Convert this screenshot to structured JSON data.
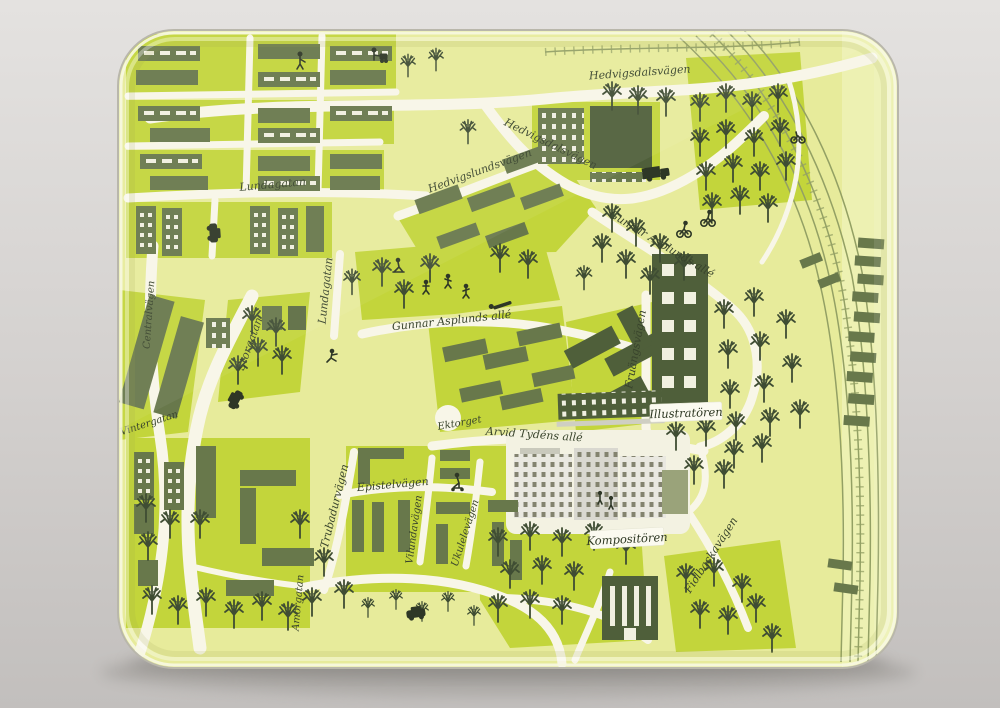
{
  "scene": {
    "description": "Photograph of a rectangular melamine serving tray printed with an illustrated yellow-green city map",
    "background_color": "#d6d3d1",
    "shadow_color": "#8e8b86"
  },
  "tray": {
    "shape": "rounded-rectangle",
    "rim_highlight_color": "#f7f8e2",
    "edge_line_color": "#b9b7ab"
  },
  "map": {
    "palette": {
      "base": "#e7eb9b",
      "block": "#c3d53b",
      "road": "#f8f6e8",
      "building": "#68784b",
      "building_dark": "#4f5f3a",
      "tree": "#3f4d33",
      "white_building": "#e9e8e0",
      "railway": "#93a064",
      "label_ink": "#39442c",
      "badge_background": "#fbfaf0"
    },
    "labels": [
      {
        "id": "hedvigsdalsvagen-top",
        "text": "Hedvigsdalsvägen"
      },
      {
        "id": "hedvigsdalsvagen-mid",
        "text": "Hedvigsdalsvägen"
      },
      {
        "id": "lundagatan-horizontal",
        "text": "Lundagatan"
      },
      {
        "id": "hedvigslundsvagen",
        "text": "Hedvigslundsvägen"
      },
      {
        "id": "gunnar-asplunds-alle-diagonal",
        "text": "Gunnar Asplunds allé"
      },
      {
        "id": "lundagatan-vertical",
        "text": "Lundagatan"
      },
      {
        "id": "storgatan",
        "text": "Storgatan"
      },
      {
        "id": "gunnar-asplunds-alle-horizontal",
        "text": "Gunnar Asplunds allé"
      },
      {
        "id": "fruangsvagen",
        "text": "Fruängsvägen"
      },
      {
        "id": "ektorget",
        "text": "Ektorget"
      },
      {
        "id": "arvid-tydens-alle",
        "text": "Arvid Tydéns allé"
      },
      {
        "id": "epistelvagen",
        "text": "Epistelvägen"
      },
      {
        "id": "trubadurvagen",
        "text": "Trubadurvägen"
      },
      {
        "id": "vilundavagen",
        "text": "Vilundavägen"
      },
      {
        "id": "ukulelevagen",
        "text": "Ukulelevägen"
      },
      {
        "id": "centralvagen",
        "text": "Centralvägen"
      },
      {
        "id": "vintergatan",
        "text": "Vintergatan"
      },
      {
        "id": "amorgatan",
        "text": "Amorgatan"
      },
      {
        "id": "fiolbackavagen",
        "text": "Fiolbackavägen"
      }
    ],
    "badges": [
      {
        "id": "illustratoren",
        "text": "Illustratören"
      },
      {
        "id": "kompositoren",
        "text": "Kompositören"
      }
    ],
    "pictograms": [
      "tree-icon",
      "truck-icon",
      "car-icon",
      "van-icon",
      "cyclist-icon",
      "pram-walker-icon",
      "playing-kids-icon",
      "bench-person-icon",
      "runner-icon",
      "scooter-icon",
      "train-cars-icon"
    ]
  }
}
